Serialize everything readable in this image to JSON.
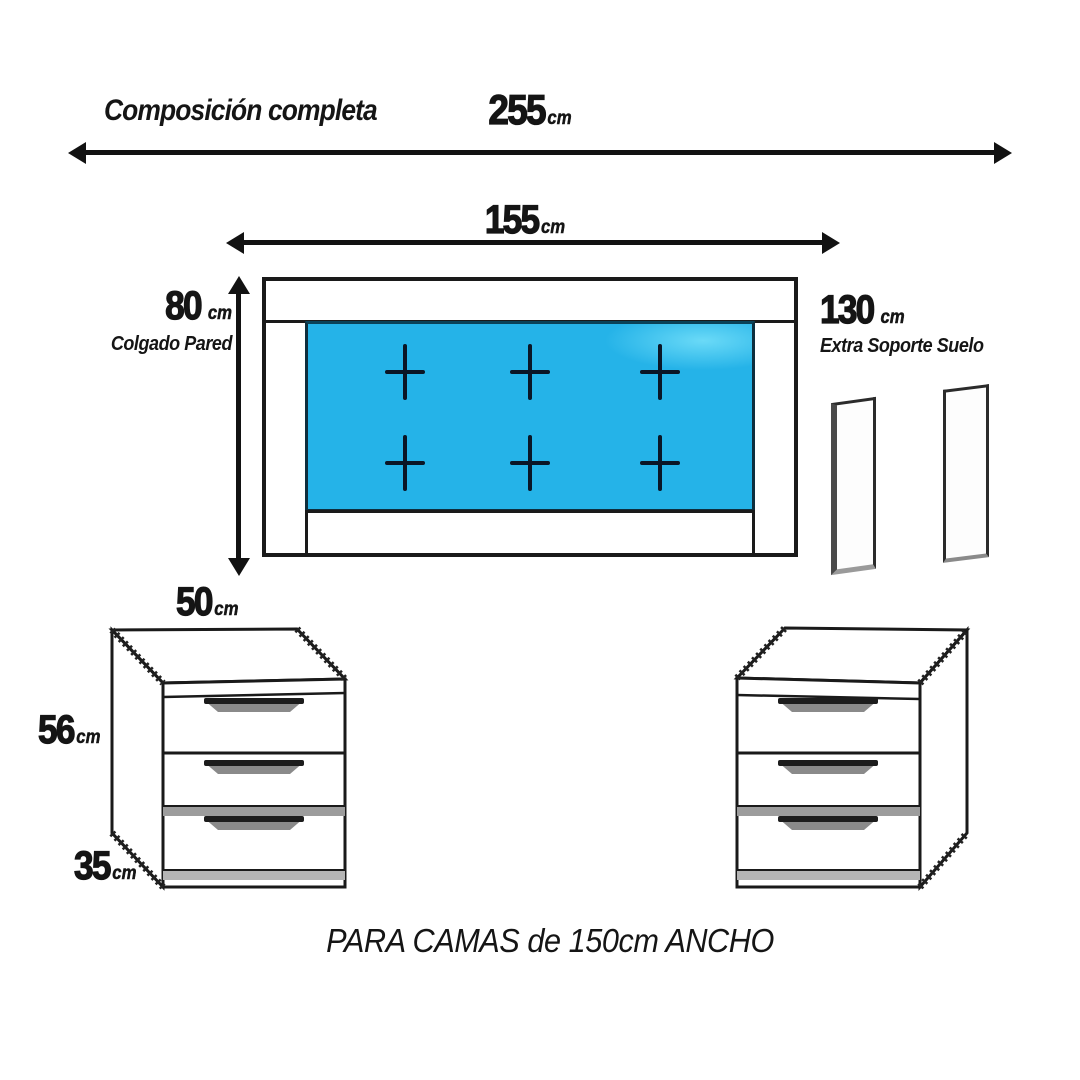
{
  "title": "Composición completa",
  "footer": "PARA CAMAS de 150cm ANCHO",
  "dims": {
    "total_width": {
      "value": "255",
      "unit": "cm"
    },
    "headboard_width": {
      "value": "155",
      "unit": "cm"
    },
    "headboard_height": {
      "value": "80",
      "unit": "cm",
      "caption": "Colgado Pared"
    },
    "floor_support_height": {
      "value": "130",
      "unit": "cm",
      "caption": "Extra Soporte Suelo"
    },
    "nightstand_width": {
      "value": "50",
      "unit": "cm"
    },
    "nightstand_height": {
      "value": "56",
      "unit": "cm"
    },
    "nightstand_depth": {
      "value": "35",
      "unit": "cm"
    }
  },
  "colors": {
    "upholstery_blue": "#25b3e8",
    "outline_black": "#1a1a1a",
    "button_navy": "#0a1626",
    "handle_dark": "#1c1c1c",
    "shadow_gray": "#9c9c9c"
  }
}
